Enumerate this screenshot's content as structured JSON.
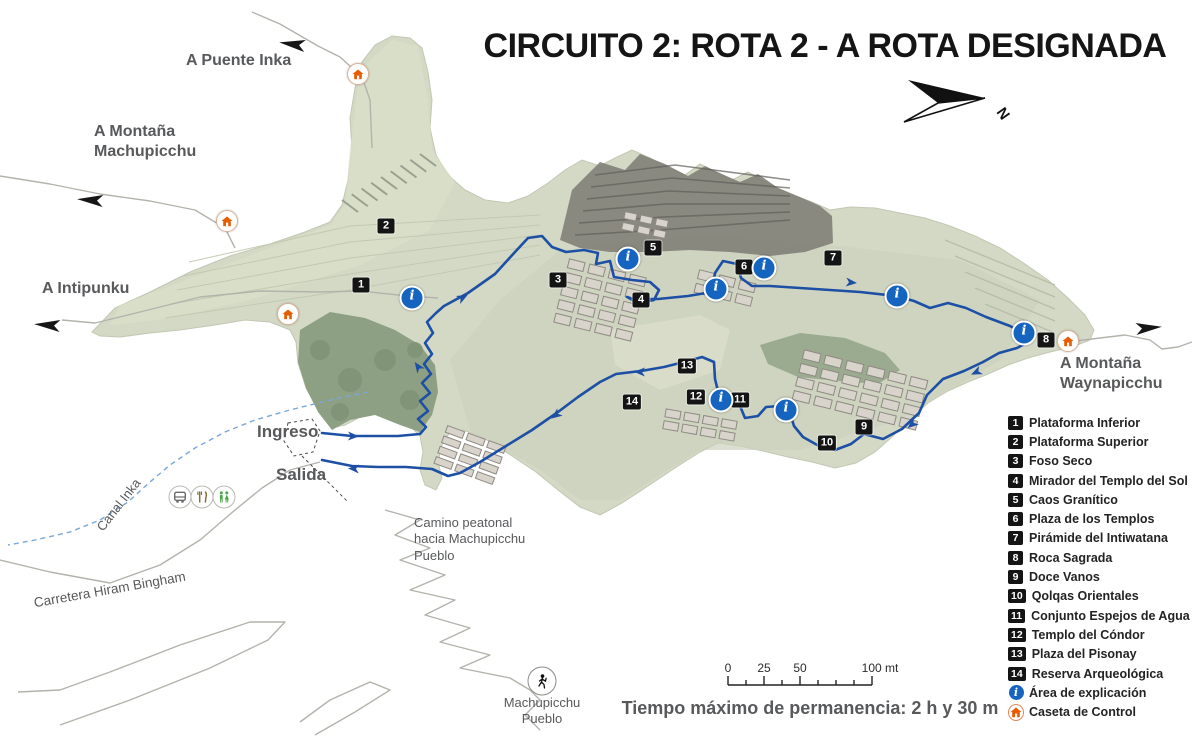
{
  "title": "CIRCUITO 2: ROTA 2 - A ROTA DESIGNADA",
  "compass": {
    "label": "N"
  },
  "colors": {
    "route_blue": "#1d4fa5",
    "info_blue": "#1565c0",
    "control_orange": "#e65c00",
    "badge_black": "#141414",
    "label_gray": "#58595b"
  },
  "legend": {
    "items": [
      {
        "badge": "1",
        "label": "Plataforma Inferior"
      },
      {
        "badge": "2",
        "label": "Plataforma Superior"
      },
      {
        "badge": "3",
        "label": "Foso Seco"
      },
      {
        "badge": "4",
        "label": "Mirador del Templo del Sol"
      },
      {
        "badge": "5",
        "label": "Caos Granítico"
      },
      {
        "badge": "6",
        "label": "Plaza de los Templos"
      },
      {
        "badge": "7",
        "label": "Pirámide del Intiwatana"
      },
      {
        "badge": "8",
        "label": "Roca Sagrada"
      },
      {
        "badge": "9",
        "label": "Doce Vanos"
      },
      {
        "badge": "10",
        "label": "Qolqas Orientales"
      },
      {
        "badge": "11",
        "label": "Conjunto Espejos de Agua"
      },
      {
        "badge": "12",
        "label": "Templo del Cóndor"
      },
      {
        "badge": "13",
        "label": "Plaza del Pisonay"
      },
      {
        "badge": "14",
        "label": "Reserva Arqueológica"
      },
      {
        "icon": "info",
        "label": "Área de explicación"
      },
      {
        "icon": "control",
        "label": "Caseta de Control"
      }
    ]
  },
  "footer": {
    "max_time": "Tiempo máximo de permanencia: 2 h y 30 m",
    "scale_labels": [
      {
        "text": "0",
        "x": 728
      },
      {
        "text": "25",
        "x": 764
      },
      {
        "text": "50",
        "x": 800
      },
      {
        "text": "100 mt",
        "x": 880
      }
    ]
  },
  "map": {
    "labels": [
      {
        "id": "a-puente-inka",
        "text": "A Puente Inka",
        "x": 186,
        "y": 51,
        "size": 16,
        "bold": true
      },
      {
        "id": "a-montana-machupicchu",
        "text": "A Montaña\nMachupicchu",
        "x": 94,
        "y": 122,
        "size": 16,
        "bold": true
      },
      {
        "id": "a-intipunku",
        "text": "A Intipunku",
        "x": 42,
        "y": 279,
        "size": 16,
        "bold": true
      },
      {
        "id": "a-montana-waynapicchu",
        "text": "A Montaña\nWaynapicchu",
        "x": 1060,
        "y": 354,
        "size": 16,
        "bold": true
      },
      {
        "id": "ingreso",
        "text": "Ingreso",
        "x": 257,
        "y": 421,
        "size": 17,
        "bold": true
      },
      {
        "id": "salida",
        "text": "Salida",
        "x": 276,
        "y": 464,
        "size": 17,
        "bold": true
      },
      {
        "id": "canal-inka",
        "text": "Canal Inka",
        "x": 88,
        "y": 497,
        "size": 13,
        "rot": -52
      },
      {
        "id": "carretera-hiram-bingham",
        "text": "Carretera Hiram Bingham",
        "x": 33,
        "y": 582,
        "size": 13.5,
        "rot": -10
      },
      {
        "id": "camino-peatonal",
        "text": "Camino peatonal\nhacia Machupicchu\nPueblo",
        "x": 414,
        "y": 515,
        "size": 13
      }
    ],
    "markers": [
      {
        "n": "1",
        "x": 361,
        "y": 285
      },
      {
        "n": "2",
        "x": 386,
        "y": 226
      },
      {
        "n": "3",
        "x": 558,
        "y": 280
      },
      {
        "n": "4",
        "x": 641,
        "y": 300
      },
      {
        "n": "5",
        "x": 653,
        "y": 248
      },
      {
        "n": "6",
        "x": 744,
        "y": 267
      },
      {
        "n": "7",
        "x": 833,
        "y": 258
      },
      {
        "n": "8",
        "x": 1046,
        "y": 340
      },
      {
        "n": "9",
        "x": 864,
        "y": 427
      },
      {
        "n": "10",
        "x": 827,
        "y": 443
      },
      {
        "n": "11",
        "x": 740,
        "y": 400
      },
      {
        "n": "12",
        "x": 696,
        "y": 397
      },
      {
        "n": "13",
        "x": 687,
        "y": 366
      },
      {
        "n": "14",
        "x": 632,
        "y": 402
      }
    ],
    "info_points": [
      {
        "x": 412,
        "y": 298
      },
      {
        "x": 628,
        "y": 259
      },
      {
        "x": 716,
        "y": 289
      },
      {
        "x": 764,
        "y": 268
      },
      {
        "x": 897,
        "y": 296
      },
      {
        "x": 1024,
        "y": 333
      },
      {
        "x": 721,
        "y": 400
      },
      {
        "x": 786,
        "y": 410
      }
    ],
    "control_points": [
      {
        "x": 358,
        "y": 74
      },
      {
        "x": 227,
        "y": 221
      },
      {
        "x": 288,
        "y": 314
      },
      {
        "x": 1068,
        "y": 341
      }
    ],
    "direction_arrows": [
      {
        "x": 305,
        "y": 46,
        "rot": 188
      },
      {
        "x": 103,
        "y": 201,
        "rot": 184
      },
      {
        "x": 60,
        "y": 326,
        "rot": 184
      },
      {
        "x": 1136,
        "y": 329,
        "rot": -5
      }
    ],
    "route_arrows": [
      {
        "x": 348,
        "y": 436,
        "rot": 2
      },
      {
        "x": 421,
        "y": 371,
        "rot": -125
      },
      {
        "x": 458,
        "y": 300,
        "rot": -28
      },
      {
        "x": 846,
        "y": 282,
        "rot": 5
      },
      {
        "x": 645,
        "y": 372,
        "rot": 181
      },
      {
        "x": 560,
        "y": 412,
        "rot": 143
      },
      {
        "x": 981,
        "y": 370,
        "rot": 155
      },
      {
        "x": 916,
        "y": 421,
        "rot": 140
      },
      {
        "x": 359,
        "y": 469,
        "rot": 183
      }
    ],
    "services": [
      {
        "type": "bus",
        "x": 180,
        "y": 497
      },
      {
        "type": "restaurant",
        "x": 202,
        "y": 497
      },
      {
        "type": "toilets",
        "x": 224,
        "y": 497
      }
    ],
    "hiker": {
      "x": 542,
      "y": 681,
      "label": "Machupicchu\nPueblo"
    },
    "route": {
      "points": [
        [
          322,
          433
        ],
        [
          352,
          436
        ],
        [
          398,
          436
        ],
        [
          420,
          434
        ],
        [
          426,
          427
        ],
        [
          418,
          419
        ],
        [
          428,
          411
        ],
        [
          420,
          401
        ],
        [
          430,
          393
        ],
        [
          422,
          383
        ],
        [
          431,
          374
        ],
        [
          424,
          364
        ],
        [
          432,
          354
        ],
        [
          425,
          343
        ],
        [
          433,
          333
        ],
        [
          427,
          322
        ],
        [
          436,
          313
        ],
        [
          444,
          306
        ],
        [
          468,
          293
        ],
        [
          495,
          274
        ],
        [
          515,
          252
        ],
        [
          528,
          238
        ],
        [
          542,
          236
        ],
        [
          552,
          247
        ],
        [
          566,
          252
        ],
        [
          584,
          250
        ],
        [
          598,
          253
        ],
        [
          596,
          264
        ],
        [
          610,
          261
        ],
        [
          614,
          277
        ],
        [
          632,
          280
        ],
        [
          650,
          282
        ],
        [
          659,
          290
        ],
        [
          654,
          300
        ],
        [
          638,
          303
        ],
        [
          627,
          297
        ],
        [
          633,
          299
        ],
        [
          658,
          299
        ],
        [
          688,
          296
        ],
        [
          712,
          292
        ],
        [
          715,
          273
        ],
        [
          723,
          261
        ],
        [
          737,
          264
        ],
        [
          741,
          278
        ],
        [
          752,
          286
        ],
        [
          770,
          286
        ],
        [
          800,
          288
        ],
        [
          830,
          290
        ],
        [
          860,
          292
        ],
        [
          896,
          296
        ],
        [
          914,
          301
        ],
        [
          930,
          308
        ],
        [
          948,
          303
        ],
        [
          966,
          308
        ],
        [
          986,
          317
        ],
        [
          1010,
          326
        ],
        [
          1025,
          334
        ],
        [
          1028,
          342
        ],
        [
          1017,
          348
        ],
        [
          999,
          353
        ],
        [
          983,
          362
        ],
        [
          964,
          371
        ],
        [
          943,
          379
        ],
        [
          927,
          395
        ],
        [
          919,
          413
        ],
        [
          902,
          429
        ],
        [
          883,
          439
        ],
        [
          864,
          434
        ],
        [
          851,
          444
        ],
        [
          835,
          450
        ],
        [
          819,
          446
        ],
        [
          803,
          437
        ],
        [
          794,
          426
        ],
        [
          790,
          413
        ],
        [
          780,
          406
        ],
        [
          766,
          407
        ],
        [
          758,
          416
        ],
        [
          745,
          418
        ],
        [
          740,
          406
        ],
        [
          728,
          402
        ],
        [
          719,
          395
        ],
        [
          715,
          379
        ],
        [
          714,
          362
        ],
        [
          702,
          357
        ],
        [
          688,
          361
        ],
        [
          664,
          367
        ],
        [
          641,
          371
        ],
        [
          616,
          374
        ],
        [
          600,
          382
        ],
        [
          578,
          397
        ],
        [
          558,
          412
        ],
        [
          532,
          430
        ],
        [
          506,
          446
        ],
        [
          480,
          462
        ],
        [
          460,
          473
        ],
        [
          448,
          476
        ],
        [
          432,
          469
        ],
        [
          406,
          467
        ],
        [
          378,
          467
        ],
        [
          352,
          466
        ],
        [
          322,
          460
        ]
      ]
    }
  }
}
